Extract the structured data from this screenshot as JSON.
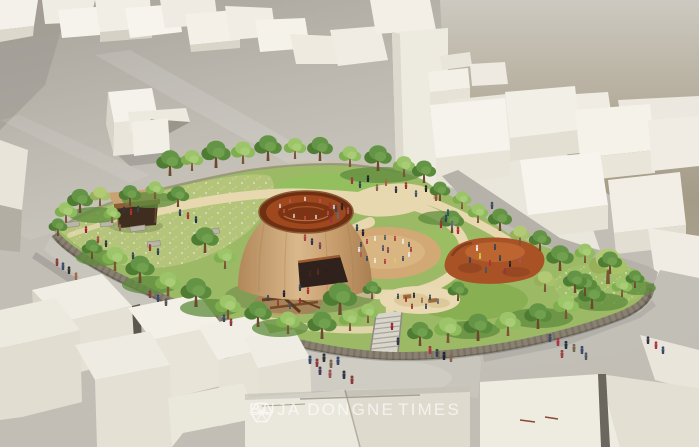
{
  "watermark": {
    "left": "BUJA DONGNE",
    "right": "TIMES",
    "icon": "hexagon-spoke-logo-icon"
  },
  "palette": {
    "sky_haze": "#a59c88",
    "hillside": "#bdb9b1",
    "building_white": "#f3f0e8",
    "park_grass": "#9cb966",
    "meadow_grass": "#b5c47c",
    "path_sand": "#e7d8b0",
    "cone_exterior": "#c89c6b",
    "cone_interior": "#a0481d",
    "play_dirt_red": "#a85226",
    "stone_wall": "#8a8172",
    "street_gray": "#c8c5bd",
    "watermark_color": "#ffffff"
  }
}
